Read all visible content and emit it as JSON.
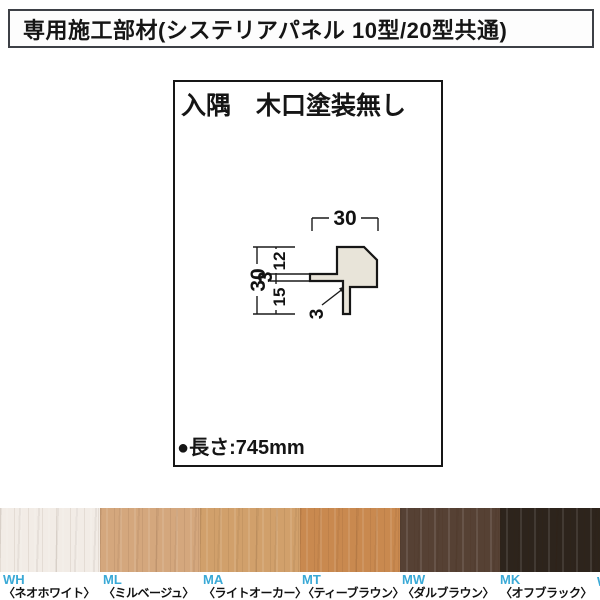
{
  "header": {
    "title": "専用施工部材(システリアパネル 10型/20型共通)"
  },
  "panel": {
    "title": "入隅　木口塗装無し",
    "length_label": "●長さ:745mm",
    "drawing": {
      "dim_width_top": "30",
      "dim_height_left": "30",
      "dim_seg_upper": "12",
      "dim_seg_flange": "3",
      "dim_seg_lower": "15",
      "dim_leader_thickness": "3",
      "profile_fill": "#e8e4d9",
      "line_color": "#1a1a1a"
    }
  },
  "swatches": [
    {
      "code": "WH",
      "name": "〈ネオホワイト〉",
      "hex": "#f2ece6"
    },
    {
      "code": "ML",
      "name": "〈ミルベージュ〉",
      "hex": "#d4a77d"
    },
    {
      "code": "MA",
      "name": "〈ライトオーカー〉",
      "hex": "#d1a06b"
    },
    {
      "code": "MT",
      "name": "〈ティーブラウン〉",
      "hex": "#c9894f"
    },
    {
      "code": "MW",
      "name": "〈ダルブラウン〉",
      "hex": "#564134"
    },
    {
      "code": "MK",
      "name": "〈オフブラック〉",
      "hex": "#2d241c"
    }
  ],
  "accent_code_color": "#3aa9d6",
  "edge_fragment": "W"
}
